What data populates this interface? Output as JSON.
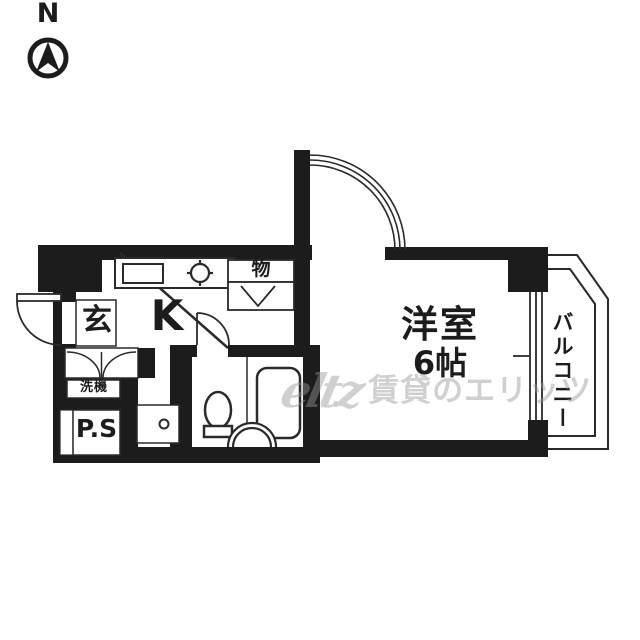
{
  "compass": {
    "north_label": "N"
  },
  "rooms": {
    "entrance_label": "玄",
    "kitchen_label": "K",
    "storage_label": "物",
    "washer_label": "洗機",
    "pipe_space_label": "P.S",
    "main_room_label": "洋室",
    "main_room_size": "6帖",
    "balcony_label": "バルコニー"
  },
  "watermark": {
    "logo": "eltz",
    "text": "賃貸のエリッツ"
  },
  "icons": {
    "compass": "north-arrow-in-circle",
    "stove": "gas-burner-circle",
    "storage_door": "v-fold-mark"
  },
  "colors": {
    "wall": "#1c1c1c",
    "line": "#2a2a2a",
    "background": "#ffffff",
    "watermark": "#969696"
  }
}
